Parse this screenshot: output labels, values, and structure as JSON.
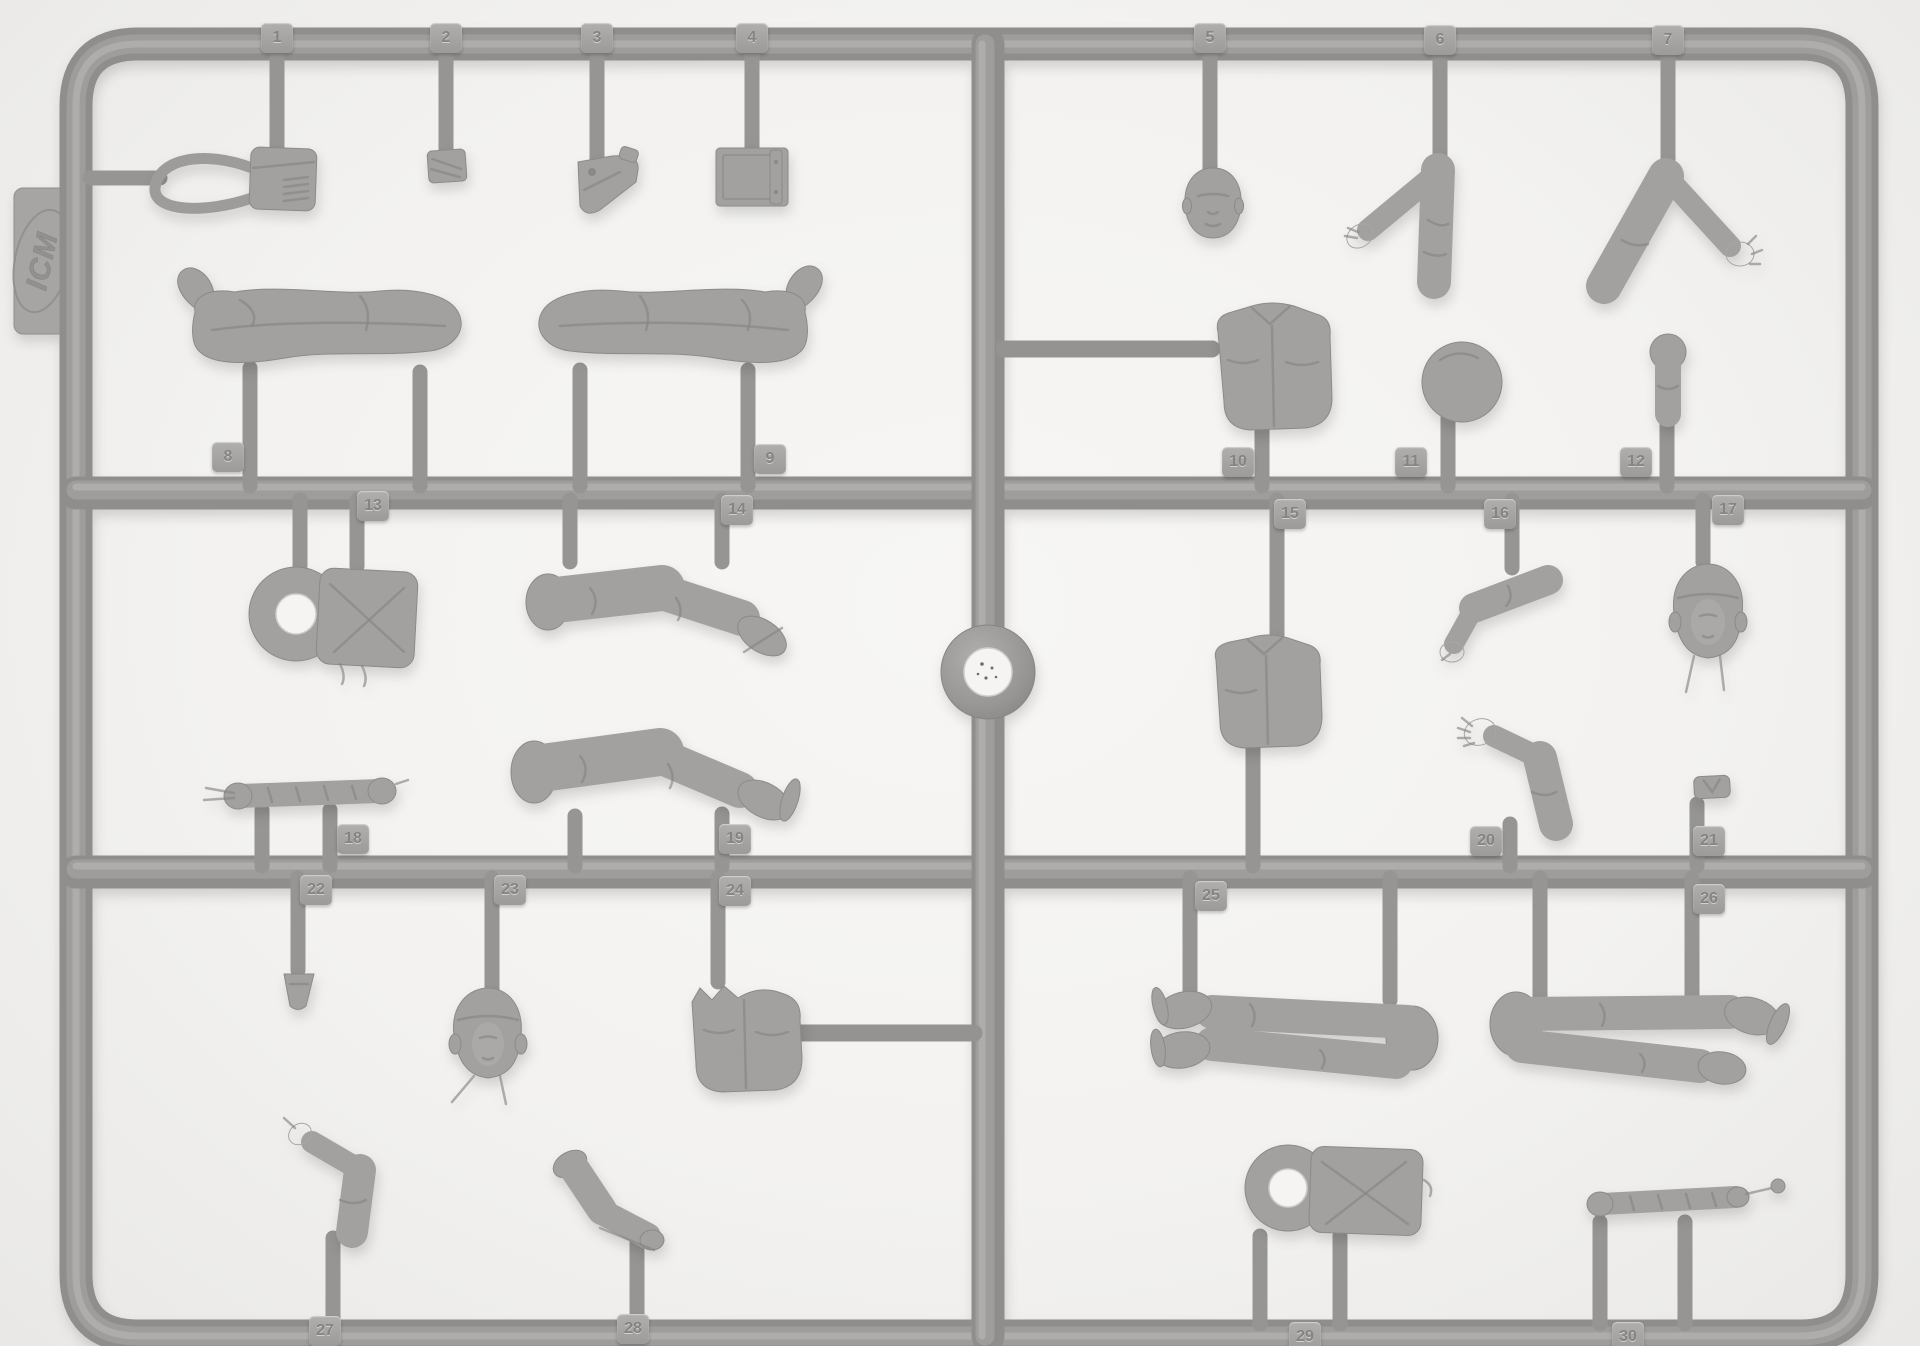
{
  "photo": {
    "subject": "gray injection-molded styrene sprue (model kit parts frame) with numbered figure parts on white background",
    "background_color": "#f3f2f0",
    "plastic_color": "#9c9b99",
    "shadow_color": "#d9d8d6"
  },
  "brand": {
    "logo_text": "ICM"
  },
  "sprue": {
    "part_count": 30,
    "center_feature": "round-ejector-ring-with-hole",
    "parts": [
      {
        "number": "1",
        "name": "pouch-with-strap",
        "tab_x": 277,
        "tab_y": 38
      },
      {
        "number": "2",
        "name": "small-pouch",
        "tab_x": 446,
        "tab_y": 38
      },
      {
        "number": "3",
        "name": "pistol-holster",
        "tab_x": 597,
        "tab_y": 38
      },
      {
        "number": "4",
        "name": "map-case",
        "tab_x": 752,
        "tab_y": 38
      },
      {
        "number": "5",
        "name": "bare-head",
        "tab_x": 1210,
        "tab_y": 38
      },
      {
        "number": "6",
        "name": "bent-arm",
        "tab_x": 1440,
        "tab_y": 40
      },
      {
        "number": "7",
        "name": "bent-arm-open-hand",
        "tab_x": 1668,
        "tab_y": 40
      },
      {
        "number": "8",
        "name": "legs-seated",
        "tab_x": 228,
        "tab_y": 457
      },
      {
        "number": "9",
        "name": "legs-seated",
        "tab_x": 770,
        "tab_y": 459
      },
      {
        "number": "10",
        "name": "torso-jacket",
        "tab_x": 1238,
        "tab_y": 462
      },
      {
        "number": "11",
        "name": "round-ball-part",
        "tab_x": 1411,
        "tab_y": 462
      },
      {
        "number": "12",
        "name": "small-capped-part",
        "tab_x": 1636,
        "tab_y": 462
      },
      {
        "number": "13",
        "name": "life-vest-with-ring",
        "tab_x": 373,
        "tab_y": 506
      },
      {
        "number": "14",
        "name": "bent-leg",
        "tab_x": 737,
        "tab_y": 510
      },
      {
        "number": "15",
        "name": "torso-jacket",
        "tab_x": 1290,
        "tab_y": 514
      },
      {
        "number": "16",
        "name": "bent-arm",
        "tab_x": 1500,
        "tab_y": 514
      },
      {
        "number": "17",
        "name": "head-flight-helmet",
        "tab_x": 1728,
        "tab_y": 510
      },
      {
        "number": "18",
        "name": "strap-roll",
        "tab_x": 353,
        "tab_y": 839
      },
      {
        "number": "19",
        "name": "bent-leg-boot",
        "tab_x": 735,
        "tab_y": 839
      },
      {
        "number": "20",
        "name": "arm-open-hand",
        "tab_x": 1486,
        "tab_y": 841
      },
      {
        "number": "21",
        "name": "small-buckle",
        "tab_x": 1709,
        "tab_y": 841
      },
      {
        "number": "22",
        "name": "small-buckle",
        "tab_x": 316,
        "tab_y": 890
      },
      {
        "number": "23",
        "name": "head-flight-helmet",
        "tab_x": 510,
        "tab_y": 890
      },
      {
        "number": "24",
        "name": "torso-jacket",
        "tab_x": 735,
        "tab_y": 891
      },
      {
        "number": "25",
        "name": "legs-pair",
        "tab_x": 1211,
        "tab_y": 896
      },
      {
        "number": "26",
        "name": "legs-pair",
        "tab_x": 1709,
        "tab_y": 899
      },
      {
        "number": "27",
        "name": "arm-pointing",
        "tab_x": 325,
        "tab_y": 1331
      },
      {
        "number": "28",
        "name": "boot-lower-leg",
        "tab_x": 633,
        "tab_y": 1329
      },
      {
        "number": "29",
        "name": "life-vest-with-ring",
        "tab_x": 1305,
        "tab_y": 1337
      },
      {
        "number": "30",
        "name": "strap-roll",
        "tab_x": 1628,
        "tab_y": 1337
      }
    ]
  }
}
